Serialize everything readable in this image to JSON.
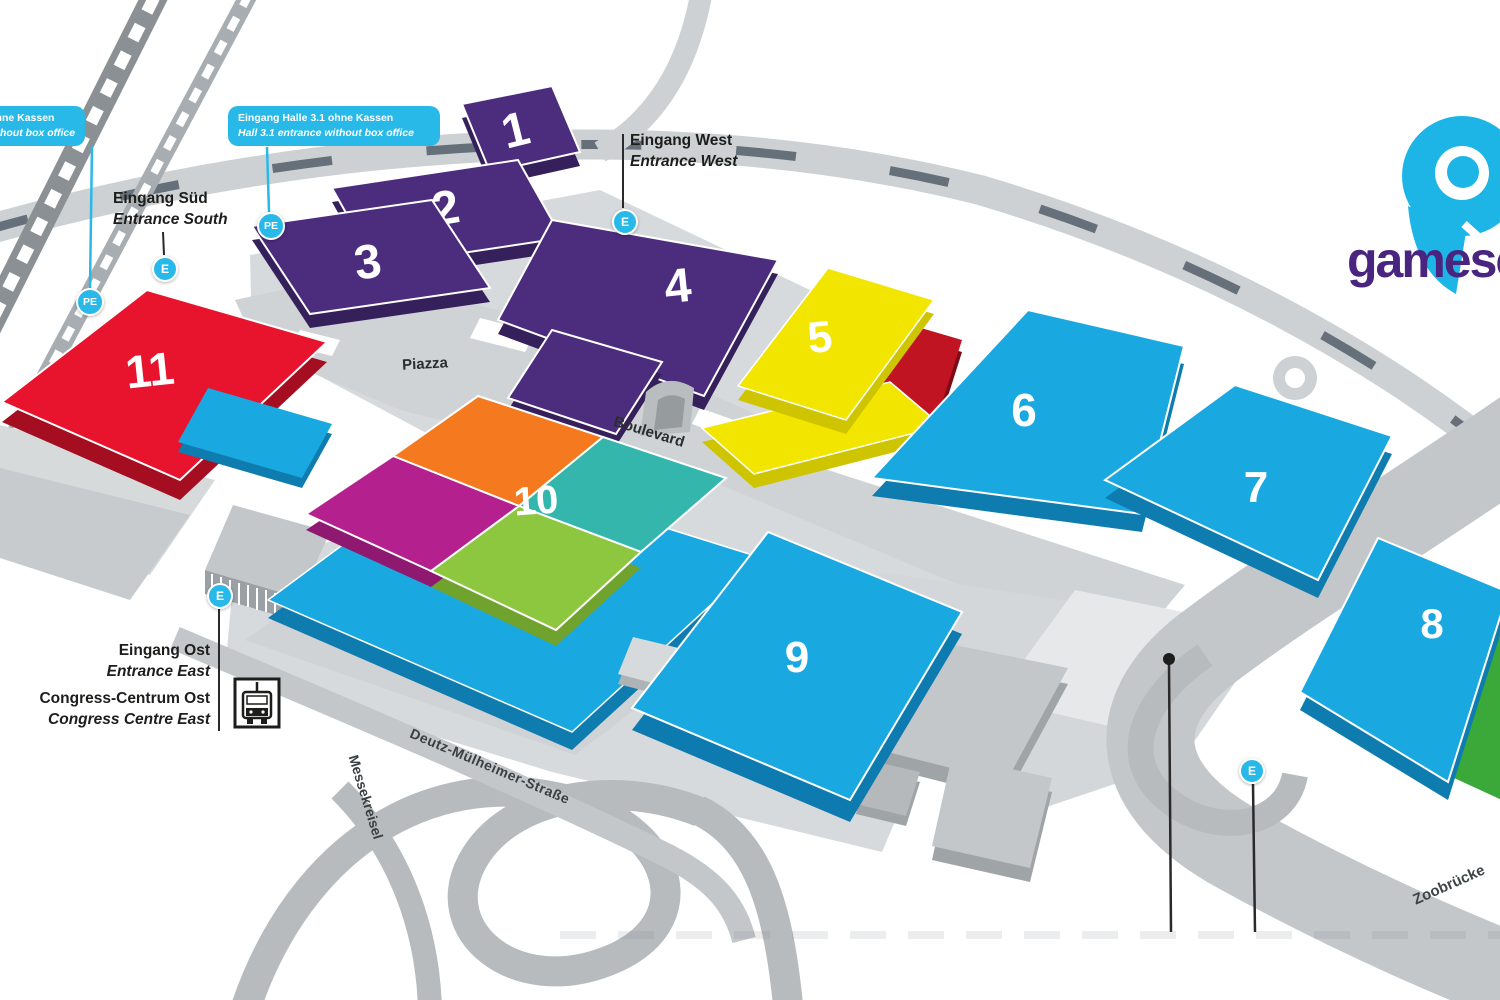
{
  "logo": {
    "wordmark": "gamescom"
  },
  "halls": {
    "h1": {
      "number": "1",
      "color": "#4b2c7d"
    },
    "h2": {
      "number": "2",
      "color": "#4b2c7d"
    },
    "h3": {
      "number": "3",
      "color": "#4b2c7d"
    },
    "h4": {
      "number": "4",
      "color": "#4b2c7d"
    },
    "h5": {
      "number": "5",
      "color": "#f2e600"
    },
    "h6": {
      "number": "6",
      "color": "#1aa8e0"
    },
    "h7": {
      "number": "7",
      "color": "#1aa8e0"
    },
    "h8": {
      "number": "8",
      "color": "#1aa8e0"
    },
    "h9": {
      "number": "9",
      "color": "#1aa8e0"
    },
    "h10": {
      "number": "10",
      "colors": {
        "north": "#f4791f",
        "east": "#35b6ac",
        "south": "#8dc63f",
        "west": "#b5208f"
      }
    },
    "h11": {
      "number": "11",
      "color": "#e8142d"
    }
  },
  "entrances": {
    "south": {
      "de": "Eingang Süd",
      "en": "Entrance South"
    },
    "west": {
      "de": "Eingang West",
      "en": "Entrance West"
    },
    "east": {
      "de": "Eingang Ost",
      "en": "Entrance East"
    }
  },
  "congress": {
    "de": "Congress-Centrum Ost",
    "en": "Congress Centre East"
  },
  "callouts": {
    "hall_11_1": {
      "de": "Eingang Halle 11.1 ohne Kassen",
      "en": "Hall 11.1 entrance without box office"
    },
    "hall_3_1": {
      "de": "Eingang Halle 3.1 ohne Kassen",
      "en": "Hall 3.1 entrance without box office"
    }
  },
  "streets": {
    "piazza": "Piazza",
    "boulevard": "Boulevard",
    "deutz": "Deutz-Mülheimer-Straße",
    "messekreisel": "Messekreisel",
    "zoobruecke": "Zoobrücke"
  },
  "badges": {
    "entrance": "E",
    "park_entrance": "PE"
  },
  "accent_color": "#29b9e8"
}
